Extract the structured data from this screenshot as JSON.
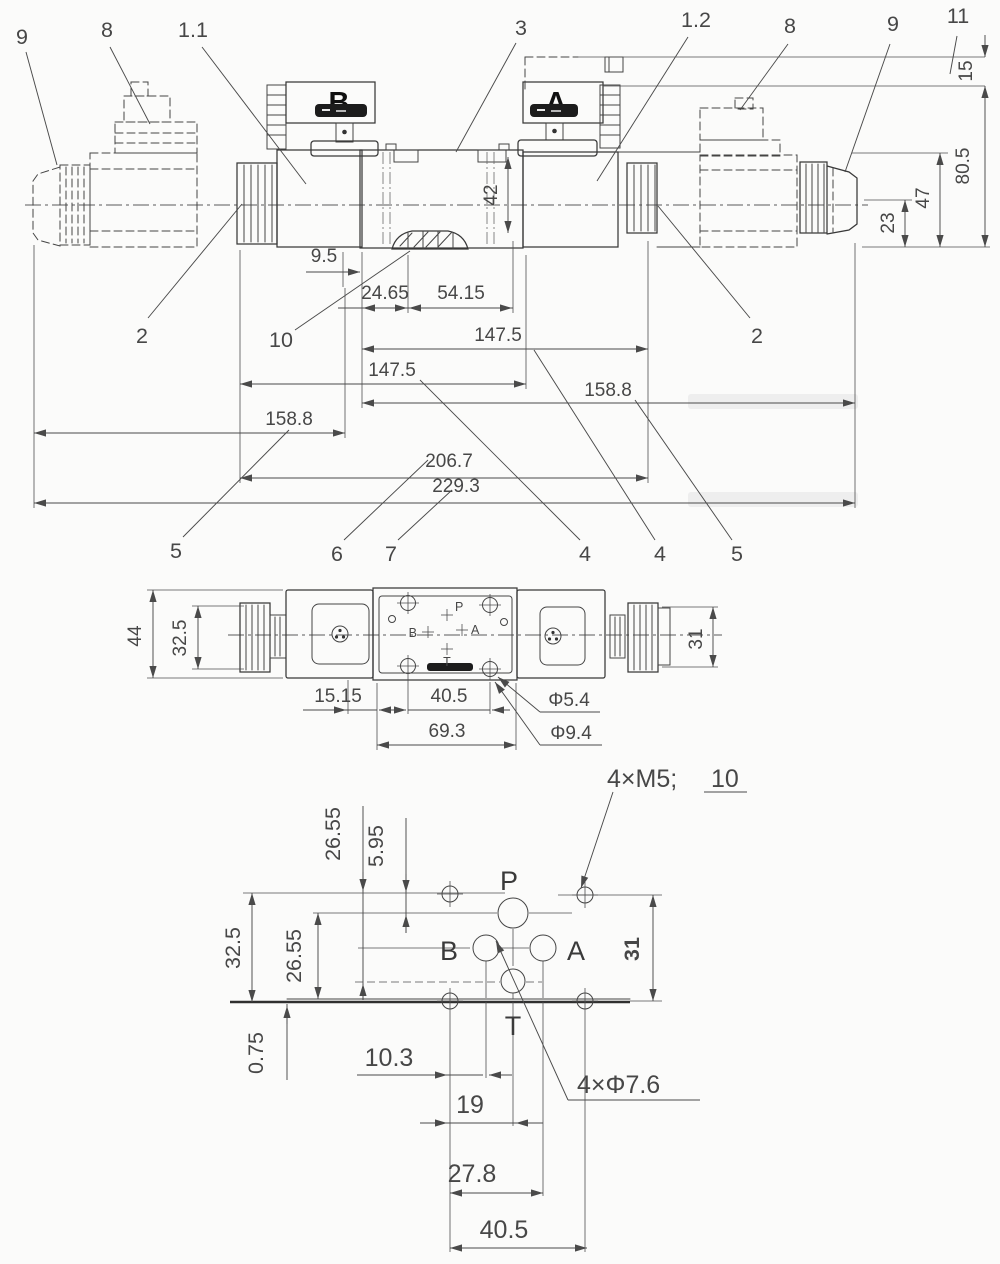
{
  "drawing": {
    "type": "engineering-dimension-drawing",
    "line_color": "#3c3c3c",
    "text_color": "#4a4a4a",
    "background": "#fbfbfa"
  },
  "front_view": {
    "connector_b": "B",
    "connector_a": "A",
    "callouts": {
      "c9_left": "9",
      "c8_left": "8",
      "c1_1": "1.1",
      "c3": "3",
      "c1_2": "1.2",
      "c8_right": "8",
      "c9_right": "9",
      "c11": "11",
      "c2_left": "2",
      "c2_right": "2",
      "c10": "10",
      "c5_left": "5",
      "c6": "6",
      "c7": "7",
      "c4_a": "4",
      "c4_b": "4",
      "c5_right": "5"
    },
    "dims": {
      "d15": "15",
      "d80_5": "80.5",
      "d47": "47",
      "d23": "23",
      "d42": "42",
      "d9_5": "9.5",
      "d24_65": "24.65",
      "d54_15": "54.15",
      "d147_5_a": "147.5",
      "d147_5_b": "147.5",
      "d158_8_right": "158.8",
      "d158_8_left": "158.8",
      "d206_7": "206.7",
      "d229_3": "229.3"
    }
  },
  "top_view": {
    "dims": {
      "d44": "44",
      "d32_5": "32.5",
      "d31": "31",
      "d15_15": "15.15",
      "d40_5": "40.5",
      "d69_3": "69.3",
      "d5_4": "Φ5.4",
      "d9_4": "Φ9.4"
    },
    "ports": {
      "p": "P",
      "b": "B",
      "a": "A",
      "t": "T"
    }
  },
  "bottom_view": {
    "dims": {
      "d26_55_top": "26.55",
      "d5_95": "5.95",
      "d32_5": "32.5",
      "d26_55_left": "26.55",
      "d0_75": "0.75",
      "d31": "31",
      "d10_3": "10.3",
      "d19": "19",
      "d27_8": "27.8",
      "d40_5": "40.5"
    },
    "ports": {
      "p": "P",
      "b": "B",
      "a": "A",
      "t": "T"
    },
    "thread_callout": "4×M5;",
    "thread_depth": "10",
    "hole_callout": "4×Φ7.6"
  }
}
